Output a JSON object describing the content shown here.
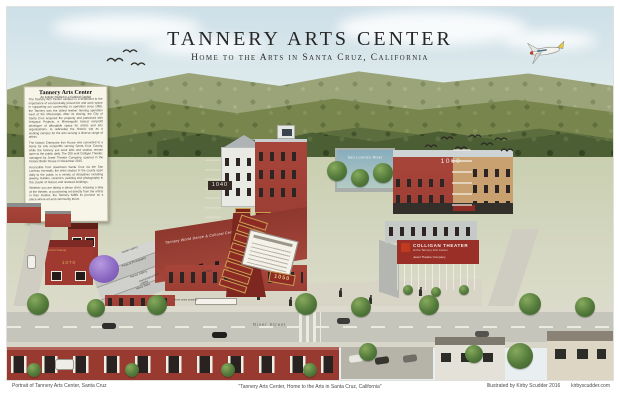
{
  "poster": {
    "title": "Tannery Arts Center",
    "subtitle": "Home to the Arts in Santa Cruz, California",
    "caption_left": "Portrait of Tannery Arts Center, Santa Cruz",
    "caption_center": "\"Tannery Arts Center, Home to the Arts in Santa Cruz, California\"",
    "caption_right_text": "Illustrated by Kirby Scudder 2016",
    "caption_right_site": "kirbyscudder.com"
  },
  "info_panel": {
    "title": "Tannery Arts Center",
    "subtitle": "An Artistic District in a Cultural Capital",
    "paragraphs": [
      "The Tannery Arts Center campus is a testament to the importance of economically priced live and work space in supporting our community. In operation since 1856, the Tannery was the oldest leather tanning operation west of the Mississippi. After its closing, the City of Santa Cruz acquired the property and partnered with Artspace Projects, a Minneapolis based nonprofit developer of affordable space for artists and arts organizations, to redevelop the historic site as a working campus for the arts serving a diverse range of artists.",
      "The historic Enterprise Iron House was converted to a home for arts nonprofits serving Santa Cruz County, while the tannery era work lofts and studios remain open to the public daily. The 200 seat Colligan Theater, managed by Jewel Theatre Company, opened in the historic Boiler House in November 2015.",
      "Accessible from downtown Santa Cruz via the San Lorenzo riverwalk, the artist studios in the county open daily to the public in a variety of disciplines including jewelry, textiles, ceramics, painting and photography in this cluster of historic and restored buildings.",
      "Whether you are taking a dance class, enjoying a play at the theater, or purchasing art directly from the artists in their studios, the Tannery fulfills its promise as a place where art and community thrive."
    ]
  },
  "buildings": {
    "arts_council": {
      "name": "Arts Council Santa Cruz County",
      "address": "1070"
    },
    "dance_center": {
      "name": "Tannery World Dance & Cultural Center"
    },
    "lofts": {
      "address": "1040"
    },
    "directory": {
      "address": "1050"
    },
    "studios_1060": {
      "address": "1060"
    },
    "colligan": {
      "name": "Colligan Theater",
      "tagline": "at the Tannery Arts Center",
      "company": "Jewel Theatre Company"
    },
    "mural": {
      "text": "San Lorenzo River"
    }
  },
  "roof_labels": [
    "Studio Gallery",
    "Props & Photography",
    "Harvey Gallery",
    "Nancy Sales"
  ],
  "misc_labels": {
    "performance": "Performance Arts Gallery",
    "studios": "Studios"
  },
  "street": {
    "name": "River Street",
    "entrance_sign": "River Street Entrance"
  }
}
